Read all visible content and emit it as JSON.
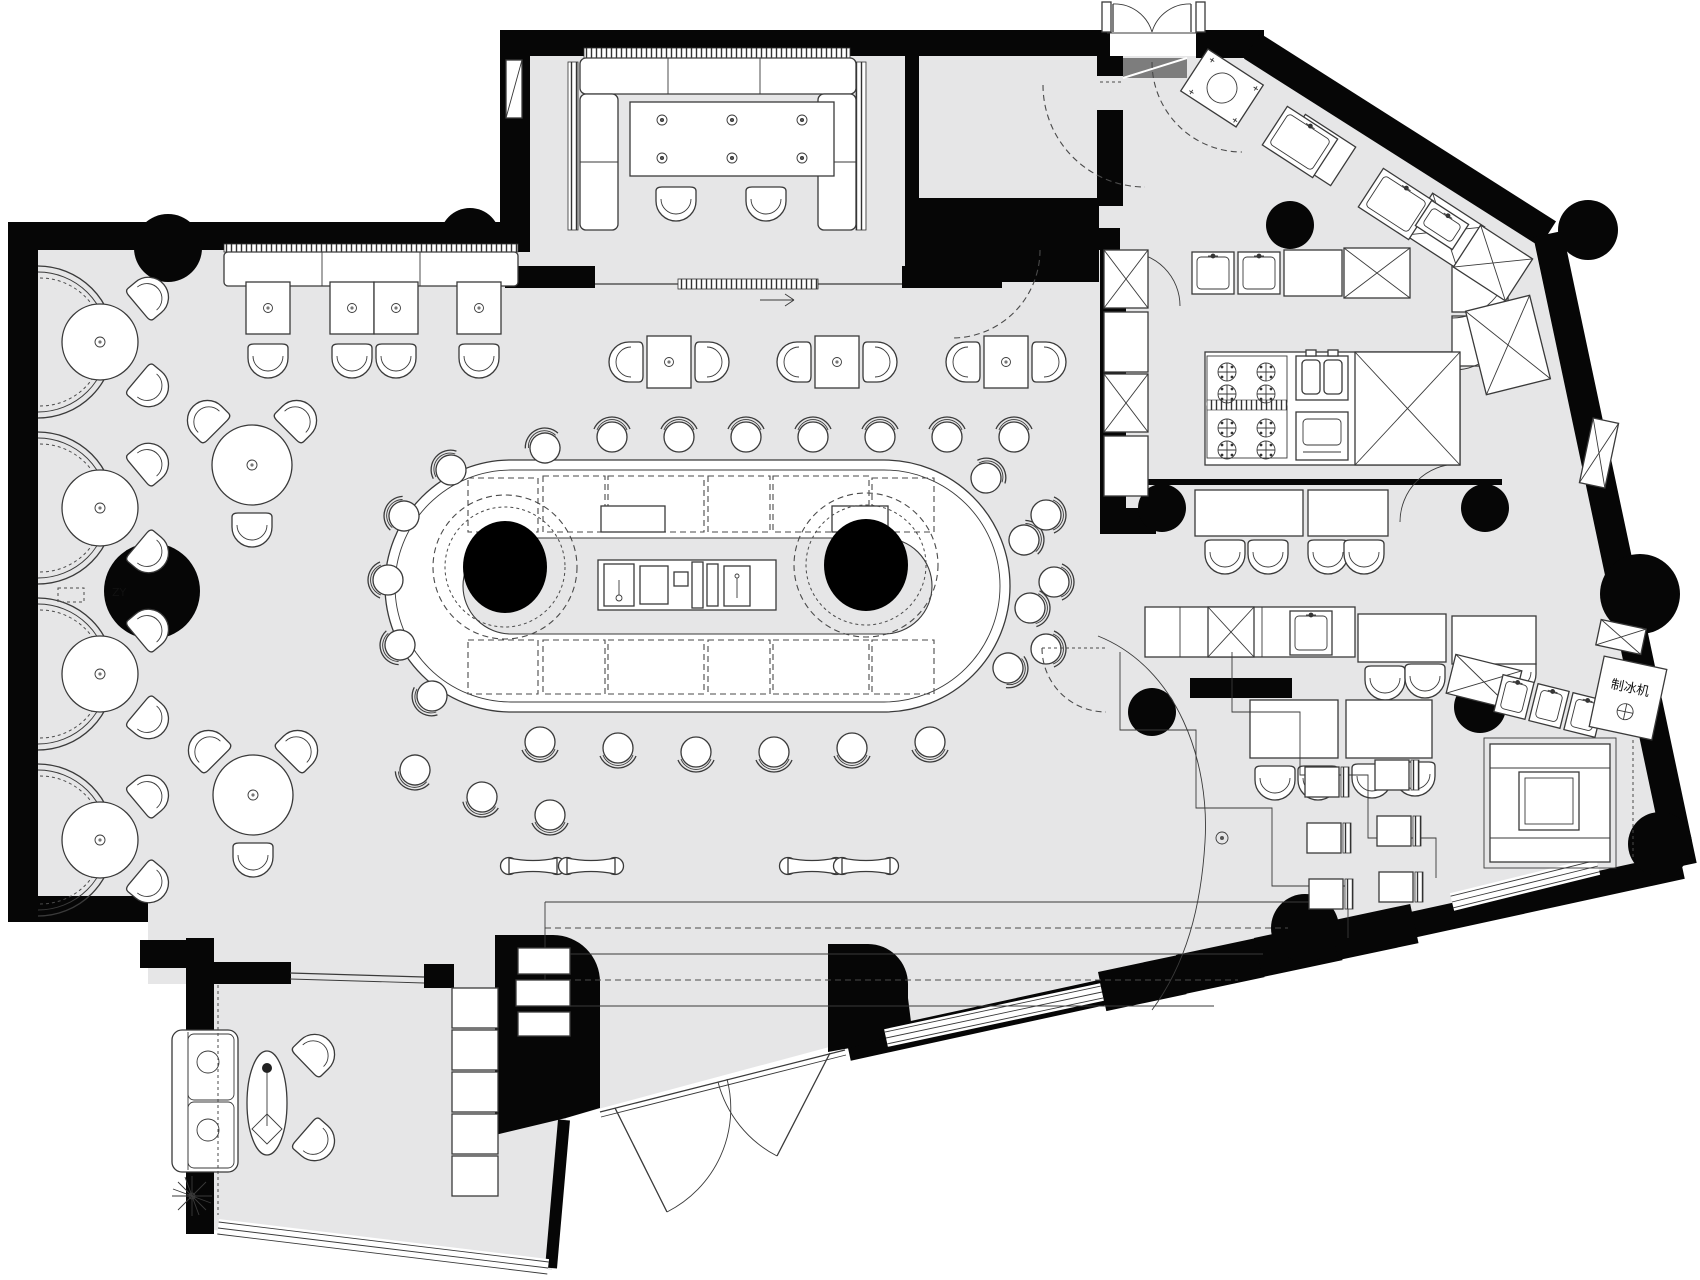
{
  "title": "restaurant-bar-floor-plan",
  "palette": {
    "floor": "#e6e6e7",
    "wall": "#060606",
    "line": "#3a3a3a",
    "white": "#ffffff"
  },
  "labels": {
    "ice_maker": "制冰机",
    "column_note": "ZY"
  },
  "plan": {
    "booth_centers_y": [
      342,
      508,
      674,
      840
    ],
    "stools": [
      [
        612,
        437,
        0
      ],
      [
        679,
        437,
        0
      ],
      [
        746,
        437,
        0
      ],
      [
        813,
        437,
        0
      ],
      [
        880,
        437,
        0
      ],
      [
        947,
        437,
        0
      ],
      [
        1014,
        437,
        0
      ],
      [
        545,
        448,
        -25
      ],
      [
        451,
        470,
        -50
      ],
      [
        404,
        516,
        -70
      ],
      [
        388,
        580,
        -90
      ],
      [
        400,
        645,
        -110
      ],
      [
        432,
        696,
        -130
      ],
      [
        540,
        742,
        180
      ],
      [
        618,
        748,
        180
      ],
      [
        696,
        752,
        180
      ],
      [
        774,
        752,
        180
      ],
      [
        852,
        748,
        180
      ],
      [
        930,
        742,
        180
      ],
      [
        986,
        478,
        40
      ],
      [
        1024,
        540,
        70
      ],
      [
        1030,
        608,
        95
      ],
      [
        1008,
        668,
        120
      ],
      [
        415,
        770,
        200
      ],
      [
        482,
        797,
        190
      ],
      [
        550,
        815,
        180
      ],
      [
        1046,
        515,
        90
      ],
      [
        1054,
        582,
        90
      ],
      [
        1046,
        649,
        90
      ]
    ],
    "chairs": [
      [
        676,
        203,
        180
      ],
      [
        766,
        203,
        180
      ],
      [
        268,
        360,
        180
      ],
      [
        352,
        360,
        180
      ],
      [
        396,
        360,
        180
      ],
      [
        479,
        360,
        180
      ],
      [
        627,
        362,
        -90
      ],
      [
        711,
        362,
        90
      ],
      [
        795,
        362,
        -90
      ],
      [
        879,
        362,
        90
      ],
      [
        964,
        362,
        -90
      ],
      [
        1048,
        362,
        90
      ],
      [
        150,
        296,
        50
      ],
      [
        150,
        388,
        130
      ],
      [
        150,
        462,
        50
      ],
      [
        150,
        554,
        130
      ],
      [
        150,
        628,
        50
      ],
      [
        150,
        720,
        130
      ],
      [
        150,
        794,
        50
      ],
      [
        150,
        884,
        130
      ],
      [
        206,
        419,
        -45
      ],
      [
        298,
        419,
        45
      ],
      [
        252,
        529,
        180
      ],
      [
        207,
        749,
        -45
      ],
      [
        299,
        749,
        45
      ],
      [
        253,
        859,
        180
      ],
      [
        316,
        1053,
        46
      ],
      [
        316,
        1142,
        131
      ],
      [
        1225,
        556,
        180
      ],
      [
        1268,
        556,
        180
      ],
      [
        1328,
        556,
        180
      ],
      [
        1364,
        556,
        180
      ],
      [
        1385,
        682,
        180
      ],
      [
        1425,
        680,
        180
      ],
      [
        1478,
        678,
        180
      ],
      [
        1516,
        676,
        180
      ],
      [
        1275,
        782,
        180
      ],
      [
        1318,
        782,
        180
      ],
      [
        1372,
        780,
        180
      ],
      [
        1415,
        778,
        180
      ]
    ],
    "tables2": [
      [
        268,
        308
      ],
      [
        352,
        308
      ],
      [
        396,
        308
      ],
      [
        479,
        308
      ],
      [
        669,
        362
      ],
      [
        837,
        362
      ],
      [
        1006,
        362
      ]
    ],
    "tripod_tables": [
      [
        252,
        465
      ],
      [
        253,
        795
      ]
    ],
    "terrace_tables": [
      [
        1322,
        782
      ],
      [
        1392,
        775
      ],
      [
        1324,
        838
      ],
      [
        1394,
        831
      ],
      [
        1326,
        894
      ],
      [
        1396,
        887
      ]
    ],
    "benches": [
      [
        533,
        866
      ],
      [
        591,
        866
      ],
      [
        812,
        866
      ],
      [
        866,
        866
      ]
    ],
    "burners": [
      [
        1227,
        372
      ],
      [
        1266,
        372
      ],
      [
        1227,
        394
      ],
      [
        1266,
        394
      ],
      [
        1227,
        428
      ],
      [
        1266,
        428
      ],
      [
        1227,
        450
      ],
      [
        1266,
        450
      ]
    ],
    "x_rects": [
      [
        1104,
        250,
        44,
        58,
        0
      ],
      [
        1104,
        374,
        44,
        58,
        0
      ],
      [
        1344,
        248,
        66,
        50,
        0
      ],
      [
        1414,
        206,
        62,
        50,
        33
      ],
      [
        1462,
        238,
        62,
        50,
        33
      ],
      [
        1355,
        352,
        105,
        113,
        0
      ],
      [
        1208,
        607,
        46,
        50,
        0
      ],
      [
        1475,
        302,
        66,
        86,
        -14
      ],
      [
        1450,
        662,
        68,
        40,
        14
      ],
      [
        1598,
        624,
        46,
        26,
        12
      ],
      [
        1586,
        420,
        26,
        66,
        12
      ]
    ],
    "sinks": [
      [
        1192,
        252,
        42,
        42,
        0
      ],
      [
        1238,
        252,
        42,
        42,
        0
      ],
      [
        1290,
        611,
        42,
        44,
        0
      ],
      [
        1270,
        119,
        60,
        46,
        33
      ],
      [
        1366,
        181,
        60,
        46,
        33
      ],
      [
        1420,
        210,
        44,
        30,
        33
      ],
      [
        1498,
        678,
        32,
        38,
        14
      ],
      [
        1533,
        687,
        32,
        38,
        14
      ],
      [
        1568,
        696,
        32,
        38,
        14
      ]
    ],
    "bar_dash_rects": [
      [
        468,
        478,
        70,
        54
      ],
      [
        543,
        476,
        62,
        56
      ],
      [
        608,
        476,
        96,
        56
      ],
      [
        708,
        476,
        62,
        56
      ],
      [
        773,
        476,
        96,
        56
      ],
      [
        872,
        478,
        62,
        54
      ],
      [
        468,
        640,
        70,
        54
      ],
      [
        543,
        640,
        62,
        54
      ],
      [
        608,
        640,
        96,
        54
      ],
      [
        708,
        640,
        62,
        54
      ],
      [
        773,
        640,
        96,
        54
      ],
      [
        872,
        640,
        62,
        54
      ]
    ],
    "bar_solid_rects": [
      [
        601,
        506,
        64,
        26
      ],
      [
        832,
        506,
        56,
        26
      ]
    ],
    "black_steps": [
      [
        1098,
        972
      ],
      [
        1176,
        955
      ],
      [
        1254,
        938
      ],
      [
        1330,
        921
      ]
    ],
    "grand_steps": [
      [
        545,
        902,
        1312,
        0
      ],
      [
        545,
        928,
        1288,
        1
      ],
      [
        545,
        954,
        1263,
        0
      ],
      [
        545,
        980,
        1238,
        1
      ],
      [
        545,
        1006,
        1214,
        0
      ]
    ],
    "lounge_treads": [
      [
        452,
        988
      ],
      [
        452,
        1030
      ],
      [
        452,
        1072
      ],
      [
        452,
        1114
      ],
      [
        452,
        1156
      ]
    ],
    "blob_treads": [
      [
        518,
        948,
        52,
        26
      ],
      [
        516,
        980,
        54,
        26
      ],
      [
        518,
        1012,
        52,
        24
      ]
    ],
    "columns": [
      [
        168,
        248,
        34
      ],
      [
        470,
        238,
        30
      ],
      [
        152,
        591,
        48
      ],
      [
        1290,
        225,
        24
      ],
      [
        1588,
        230,
        30
      ],
      [
        1640,
        594,
        40
      ],
      [
        1305,
        928,
        34
      ],
      [
        1660,
        844,
        32
      ],
      [
        1162,
        508,
        24
      ],
      [
        1485,
        508,
        24
      ],
      [
        1152,
        712,
        24
      ],
      [
        1480,
        707,
        26
      ]
    ]
  }
}
